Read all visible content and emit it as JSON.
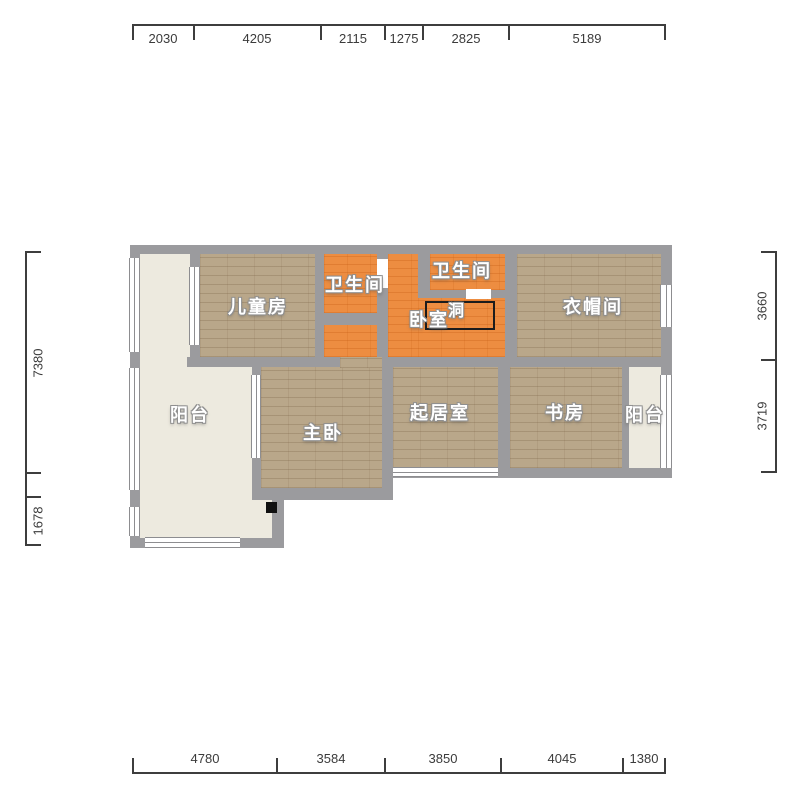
{
  "title": "apartment-floor-plan",
  "colors": {
    "wall": "#9b9b9e",
    "wood_floor": "#b9a78a",
    "orange_floor": "#ed8d41",
    "balcony_floor": "#edeadf",
    "window": "#ffffff",
    "dimension_text": "#3b3b3b",
    "room_label": "#ffffff"
  },
  "rooms": {
    "children_room": "儿童房",
    "bathroom_1": "卫生间",
    "bathroom_2": "卫生间",
    "bedroom": "卧室",
    "hole": "洞",
    "cloakroom": "衣帽间",
    "balcony_left": "阳台",
    "master_bedroom": "主卧",
    "living_room": "起居室",
    "study": "书房",
    "balcony_right": "阳台"
  },
  "dimensions_mm": {
    "top": [
      2030,
      4205,
      2115,
      1275,
      2825,
      5189
    ],
    "bottom": [
      4780,
      3584,
      3850,
      4045,
      1380
    ],
    "left": [
      7380,
      1678
    ],
    "right": [
      3660,
      3719
    ]
  },
  "floorplan": {
    "floors": [
      {
        "name": "floor-balcony-left-top",
        "type": "cream",
        "x": 140,
        "y": 254,
        "w": 50,
        "h": 103
      },
      {
        "name": "floor-balcony-left-main",
        "type": "cream",
        "x": 140,
        "y": 357,
        "w": 112,
        "h": 181
      },
      {
        "name": "floor-balcony-left-foot",
        "type": "cream",
        "x": 252,
        "y": 500,
        "w": 20,
        "h": 38
      },
      {
        "name": "floor-children-room",
        "type": "wood",
        "x": 200,
        "y": 254,
        "w": 115,
        "h": 103
      },
      {
        "name": "floor-bathroom-1",
        "type": "orange",
        "x": 324,
        "y": 254,
        "w": 53,
        "h": 59
      },
      {
        "name": "floor-bathroom-2",
        "type": "orange",
        "x": 430,
        "y": 254,
        "w": 75,
        "h": 36
      },
      {
        "name": "floor-bedroom-a",
        "type": "orange",
        "x": 388,
        "y": 254,
        "w": 30,
        "h": 103
      },
      {
        "name": "floor-bedroom-b",
        "type": "orange",
        "x": 418,
        "y": 298,
        "w": 87,
        "h": 59
      },
      {
        "name": "floor-bedroom-c",
        "type": "orange",
        "x": 324,
        "y": 325,
        "w": 64,
        "h": 32
      },
      {
        "name": "floor-cloakroom",
        "type": "wood",
        "x": 517,
        "y": 254,
        "w": 144,
        "h": 103
      },
      {
        "name": "floor-master-bedroom",
        "type": "wood",
        "x": 261,
        "y": 367,
        "w": 121,
        "h": 121
      },
      {
        "name": "floor-master-door-gap",
        "type": "wood",
        "x": 340,
        "y": 357,
        "w": 42,
        "h": 11
      },
      {
        "name": "floor-living-room",
        "type": "wood",
        "x": 393,
        "y": 367,
        "w": 105,
        "h": 101
      },
      {
        "name": "floor-study",
        "type": "wood",
        "x": 510,
        "y": 367,
        "w": 112,
        "h": 101
      },
      {
        "name": "floor-balcony-right",
        "type": "cream",
        "x": 629,
        "y": 367,
        "w": 32,
        "h": 101
      }
    ],
    "walls": [
      {
        "name": "wall-top",
        "x": 130,
        "y": 245,
        "w": 542,
        "h": 9
      },
      {
        "name": "wall-right",
        "x": 661,
        "y": 245,
        "w": 11,
        "h": 233
      },
      {
        "name": "wall-bottom-main",
        "x": 382,
        "y": 468,
        "w": 290,
        "h": 10
      },
      {
        "name": "wall-left-outer",
        "x": 130,
        "y": 245,
        "w": 10,
        "h": 303
      },
      {
        "name": "wall-mid-left",
        "x": 187,
        "y": 357,
        "w": 153,
        "h": 10
      },
      {
        "name": "wall-mid-right",
        "x": 382,
        "y": 357,
        "w": 279,
        "h": 10
      },
      {
        "name": "wall-balcony-children",
        "x": 190,
        "y": 253,
        "w": 10,
        "h": 104
      },
      {
        "name": "wall-children-bathroom",
        "x": 315,
        "y": 253,
        "w": 9,
        "h": 104
      },
      {
        "name": "wall-bathroom1-right",
        "x": 377,
        "y": 253,
        "w": 11,
        "h": 104
      },
      {
        "name": "wall-bathroom1-bottom",
        "x": 315,
        "y": 313,
        "w": 73,
        "h": 12
      },
      {
        "name": "wall-bathroom2-left",
        "x": 418,
        "y": 253,
        "w": 12,
        "h": 45
      },
      {
        "name": "wall-bathroom2-bottom-left",
        "x": 418,
        "y": 290,
        "w": 48,
        "h": 8
      },
      {
        "name": "wall-bathroom2-bottom-right",
        "x": 491,
        "y": 290,
        "w": 26,
        "h": 8
      },
      {
        "name": "wall-bedroom-cloakroom",
        "x": 505,
        "y": 253,
        "w": 12,
        "h": 114
      },
      {
        "name": "wall-living-study",
        "x": 498,
        "y": 357,
        "w": 12,
        "h": 121
      },
      {
        "name": "wall-study-balcony",
        "x": 622,
        "y": 367,
        "w": 7,
        "h": 101
      },
      {
        "name": "wall-master-left",
        "x": 252,
        "y": 357,
        "w": 9,
        "h": 143
      },
      {
        "name": "wall-master-right",
        "x": 382,
        "y": 357,
        "w": 11,
        "h": 143
      },
      {
        "name": "wall-master-bottom",
        "x": 252,
        "y": 488,
        "w": 141,
        "h": 12
      },
      {
        "name": "wall-balcony-step",
        "x": 272,
        "y": 495,
        "w": 12,
        "h": 53
      },
      {
        "name": "wall-balcony-bottom",
        "x": 130,
        "y": 538,
        "w": 154,
        "h": 10
      },
      {
        "name": "wall-left-mid-block",
        "x": 130,
        "y": 352,
        "w": 10,
        "h": 16
      },
      {
        "name": "wall-left-low-block",
        "x": 130,
        "y": 493,
        "w": 10,
        "h": 14
      }
    ],
    "windows": [
      {
        "name": "window-left-upper",
        "o": "v",
        "x": 129,
        "y": 258,
        "w": 11,
        "h": 94
      },
      {
        "name": "window-left-lower",
        "o": "v",
        "x": 129,
        "y": 368,
        "w": 11,
        "h": 122
      },
      {
        "name": "window-left-foot",
        "o": "v",
        "x": 129,
        "y": 507,
        "w": 11,
        "h": 29
      },
      {
        "name": "window-balcony-children",
        "o": "v",
        "x": 189,
        "y": 267,
        "w": 11,
        "h": 78
      },
      {
        "name": "window-cloakroom-right",
        "o": "v",
        "x": 660,
        "y": 285,
        "w": 12,
        "h": 42
      },
      {
        "name": "window-balcony-right",
        "o": "v",
        "x": 660,
        "y": 375,
        "w": 12,
        "h": 93
      },
      {
        "name": "window-master-left",
        "o": "v",
        "x": 251,
        "y": 375,
        "w": 10,
        "h": 83
      },
      {
        "name": "window-living-bottom",
        "o": "h",
        "x": 393,
        "y": 467,
        "w": 105,
        "h": 10
      },
      {
        "name": "window-balcony-bottom",
        "o": "h",
        "x": 145,
        "y": 537,
        "w": 95,
        "h": 11
      }
    ],
    "doors": [
      {
        "name": "door-bathroom-1",
        "x": 377,
        "y": 259,
        "w": 11,
        "h": 29
      },
      {
        "name": "door-bathroom-2",
        "x": 466,
        "y": 289,
        "w": 25,
        "h": 10
      }
    ],
    "extras": [
      {
        "name": "hole-outline",
        "type": "hole",
        "x": 425,
        "y": 301,
        "w": 70,
        "h": 29
      },
      {
        "name": "column-marker",
        "type": "square",
        "x": 266,
        "y": 502,
        "w": 11,
        "h": 11
      }
    ],
    "labels": [
      {
        "name": "label-children-room",
        "bind": "rooms.children_room",
        "x": 258,
        "y": 306,
        "s": 18
      },
      {
        "name": "label-bathroom-1",
        "bind": "rooms.bathroom_1",
        "x": 355,
        "y": 284,
        "s": 18
      },
      {
        "name": "label-bathroom-2",
        "bind": "rooms.bathroom_2",
        "x": 462,
        "y": 270,
        "s": 18
      },
      {
        "name": "label-bedroom",
        "bind": "rooms.bedroom",
        "x": 429,
        "y": 319,
        "s": 18
      },
      {
        "name": "label-hole",
        "bind": "rooms.hole",
        "x": 457,
        "y": 309,
        "s": 16
      },
      {
        "name": "label-cloakroom",
        "bind": "rooms.cloakroom",
        "x": 593,
        "y": 306,
        "s": 18
      },
      {
        "name": "label-balcony-left",
        "bind": "rooms.balcony_left",
        "x": 190,
        "y": 414,
        "s": 18
      },
      {
        "name": "label-master-bedroom",
        "bind": "rooms.master_bedroom",
        "x": 323,
        "y": 432,
        "s": 18
      },
      {
        "name": "label-living-room",
        "bind": "rooms.living_room",
        "x": 440,
        "y": 412,
        "s": 18
      },
      {
        "name": "label-study",
        "bind": "rooms.study",
        "x": 565,
        "y": 412,
        "s": 18
      },
      {
        "name": "label-balcony-right",
        "bind": "rooms.balcony_right",
        "x": 645,
        "y": 414,
        "s": 18
      }
    ]
  },
  "rulers": {
    "top": {
      "line": {
        "x1": 133,
        "x2": 665,
        "y": 24
      },
      "ticks": [
        133,
        194,
        321,
        385,
        423,
        509,
        665
      ],
      "labels": [
        {
          "text": "2030",
          "c": 163
        },
        {
          "text": "4205",
          "c": 257
        },
        {
          "text": "2115",
          "c": 353
        },
        {
          "text": "1275",
          "c": 404
        },
        {
          "text": "2825",
          "c": 466
        },
        {
          "text": "5189",
          "c": 587
        }
      ]
    },
    "bottom": {
      "line": {
        "x1": 133,
        "x2": 665,
        "y": 772
      },
      "ticks": [
        133,
        277,
        385,
        501,
        623,
        665
      ],
      "labels": [
        {
          "text": "4780",
          "c": 205
        },
        {
          "text": "3584",
          "c": 331
        },
        {
          "text": "3850",
          "c": 443
        },
        {
          "text": "4045",
          "c": 562
        },
        {
          "text": "1380",
          "c": 644
        }
      ]
    },
    "left": {
      "line": {
        "y1": 252,
        "y2": 545,
        "x": 25
      },
      "ticks": [
        252,
        473,
        497,
        545
      ],
      "labels": [
        {
          "text": "7380",
          "c": 363
        },
        {
          "text": "1678",
          "c": 521
        }
      ]
    },
    "right": {
      "line": {
        "y1": 252,
        "y2": 472,
        "x": 775
      },
      "ticks": [
        252,
        360,
        472
      ],
      "labels": [
        {
          "text": "3660",
          "c": 306
        },
        {
          "text": "3719",
          "c": 416
        }
      ]
    }
  }
}
